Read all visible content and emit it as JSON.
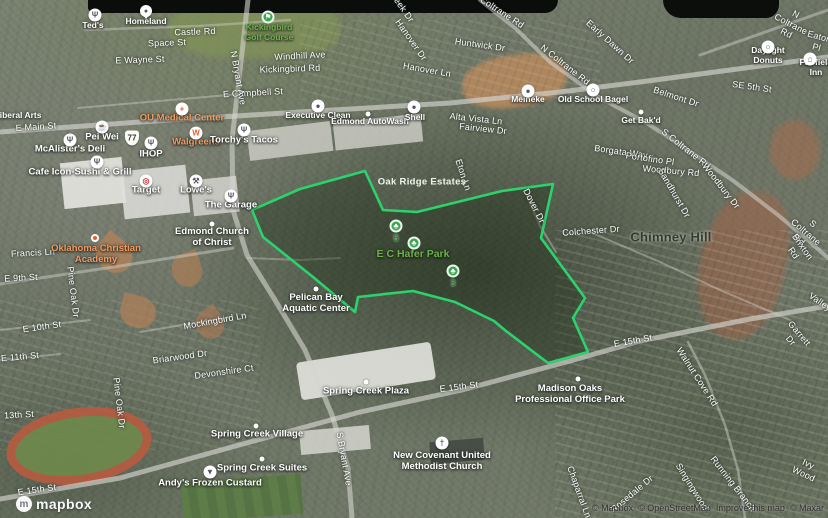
{
  "map": {
    "view": "satellite-3d",
    "route_shield": "77",
    "logo_text": "mapbox",
    "attribution": [
      "© Mapbox",
      "© OpenStreetMap",
      "Improve this map",
      "© Maxar"
    ],
    "polygon": {
      "name": "E C Hafer Park boundary highlight",
      "color": "#2bd36e",
      "points": "252,210 300,189 365,171 383,210 417,212 502,191 553,184 541,238 585,298 573,318 588,352 548,363 506,331 494,321 455,302 413,291 358,297 355,312 313,277 263,237"
    },
    "labels": [
      {
        "id": "castle-rd",
        "t": "Castle Rd",
        "x": 195,
        "y": 32,
        "r": -2,
        "c": "st"
      },
      {
        "id": "space-st",
        "t": "Space St",
        "x": 167,
        "y": 43,
        "r": -2,
        "c": "st"
      },
      {
        "id": "e-wayne-st",
        "t": "E Wayne St",
        "x": 140,
        "y": 60,
        "r": -2,
        "c": "st"
      },
      {
        "id": "e-campbell-st",
        "t": "E Campbell St",
        "x": 253,
        "y": 93,
        "r": -3,
        "c": "st"
      },
      {
        "id": "e-main-st",
        "t": "E Main St",
        "x": 36,
        "y": 127,
        "r": -4,
        "c": "st"
      },
      {
        "id": "n-bryant-ave",
        "t": "N Bryant Ave",
        "x": 238,
        "y": 78,
        "r": 80,
        "c": "st"
      },
      {
        "id": "windhill-ave",
        "t": "Windhill Ave",
        "x": 300,
        "y": 56,
        "r": -3,
        "c": "st"
      },
      {
        "id": "kickingbird-rd",
        "t": "Kickingbird Rd",
        "x": 290,
        "y": 69,
        "r": -2,
        "c": "st"
      },
      {
        "id": "creek-dr",
        "t": "Creek Dr",
        "x": 401,
        "y": 6,
        "r": 55,
        "c": "st"
      },
      {
        "id": "hanover-dr",
        "t": "Hanover Dr",
        "x": 411,
        "y": 40,
        "r": 55,
        "c": "st"
      },
      {
        "id": "hanover-ln",
        "t": "Hanover Ln",
        "x": 427,
        "y": 70,
        "r": 10,
        "c": "st"
      },
      {
        "id": "huntwick-dr",
        "t": "Huntwick Dr",
        "x": 480,
        "y": 45,
        "r": 8,
        "c": "st"
      },
      {
        "id": "n-coltrane-rd-1",
        "t": "N Coltrane Rd",
        "x": 498,
        "y": 10,
        "r": 33,
        "c": "st"
      },
      {
        "id": "n-coltrane-rd-2",
        "t": "N Coltrane Rd",
        "x": 565,
        "y": 65,
        "r": 38,
        "c": "st"
      },
      {
        "id": "n-coltrane-rd-3",
        "t": "N Coltrane Rd",
        "x": 791,
        "y": 24,
        "r": 27,
        "c": "st"
      },
      {
        "id": "early-dawn-dr",
        "t": "Early Dawn Dr",
        "x": 610,
        "y": 42,
        "r": 42,
        "c": "st"
      },
      {
        "id": "eaton-pl",
        "t": "Eaton Pl",
        "x": 818,
        "y": 42,
        "r": 15,
        "c": "st"
      },
      {
        "id": "se-5th-st",
        "t": "SE 5th St",
        "x": 752,
        "y": 87,
        "r": 8,
        "c": "st"
      },
      {
        "id": "belmont-dr",
        "t": "Belmont Dr",
        "x": 676,
        "y": 97,
        "r": 18,
        "c": "st"
      },
      {
        "id": "alta-vista-ln",
        "t": "Alta Vista Ln",
        "x": 476,
        "y": 119,
        "r": 6,
        "c": "st"
      },
      {
        "id": "fairview-dr",
        "t": "Fairview Dr",
        "x": 483,
        "y": 129,
        "r": 6,
        "c": "st"
      },
      {
        "id": "eton-ln",
        "t": "Eton Ln",
        "x": 463,
        "y": 175,
        "r": 72,
        "c": "st"
      },
      {
        "id": "dover-dr",
        "t": "Dover Dr",
        "x": 534,
        "y": 206,
        "r": 63,
        "c": "st"
      },
      {
        "id": "s-coltrane-rd-1",
        "t": "S Coltrane Rd",
        "x": 686,
        "y": 149,
        "r": 38,
        "c": "st"
      },
      {
        "id": "s-coltrane-rd-2",
        "t": "S Coltrane Rd",
        "x": 806,
        "y": 232,
        "r": 40,
        "c": "st"
      },
      {
        "id": "borgata-way",
        "t": "Borgata Way",
        "x": 621,
        "y": 152,
        "r": 8,
        "c": "st"
      },
      {
        "id": "portofino-pl",
        "t": "Portofino Pl",
        "x": 650,
        "y": 159,
        "r": 8,
        "c": "st"
      },
      {
        "id": "woodbury-rd",
        "t": "Woodbury Rd",
        "x": 671,
        "y": 171,
        "r": 5,
        "c": "st"
      },
      {
        "id": "woodbury-dr",
        "t": "Woodbury Dr",
        "x": 721,
        "y": 186,
        "r": 52,
        "c": "st"
      },
      {
        "id": "sandhurst-dr",
        "t": "Sandhurst Dr",
        "x": 674,
        "y": 193,
        "r": 60,
        "c": "st"
      },
      {
        "id": "colchester-dr",
        "t": "Colchester Dr",
        "x": 591,
        "y": 231,
        "r": -4,
        "c": "st"
      },
      {
        "id": "brixton-rd",
        "t": "Brixton Rd",
        "x": 798,
        "y": 250,
        "r": 55,
        "c": "st"
      },
      {
        "id": "valley-rd",
        "t": "Valley",
        "x": 820,
        "y": 302,
        "r": 35,
        "c": "st"
      },
      {
        "id": "garrett-dr",
        "t": "Garrett Dr",
        "x": 795,
        "y": 337,
        "r": 50,
        "c": "st"
      },
      {
        "id": "francis-ln",
        "t": "Francis Ln",
        "x": 33,
        "y": 253,
        "r": -3,
        "c": "st"
      },
      {
        "id": "e-9th-st",
        "t": "E 9th St",
        "x": 21,
        "y": 278,
        "r": -3,
        "c": "st"
      },
      {
        "id": "pine-oak-dr-1",
        "t": "Pine Oak Dr",
        "x": 73,
        "y": 292,
        "r": 83,
        "c": "st"
      },
      {
        "id": "pine-oak-dr-2",
        "t": "Pine Oak Dr",
        "x": 119,
        "y": 403,
        "r": 83,
        "c": "st"
      },
      {
        "id": "mockingbird-ln",
        "t": "Mockingbird Ln",
        "x": 215,
        "y": 321,
        "r": -10,
        "c": "st"
      },
      {
        "id": "e-10th-st",
        "t": "E 10th St",
        "x": 42,
        "y": 327,
        "r": -8,
        "c": "st"
      },
      {
        "id": "e-11th-st",
        "t": "E 11th St",
        "x": 20,
        "y": 357,
        "r": -5,
        "c": "st"
      },
      {
        "id": "briarwood-dr",
        "t": "Briarwood Dr",
        "x": 180,
        "y": 357,
        "r": -8,
        "c": "st"
      },
      {
        "id": "devonshire-ct",
        "t": "Devonshire Ct",
        "x": 224,
        "y": 372,
        "r": -8,
        "c": "st"
      },
      {
        "id": "13th-st",
        "t": "13th St",
        "x": 19,
        "y": 415,
        "r": -3,
        "c": "st"
      },
      {
        "id": "e-15th-st-1",
        "t": "E 15th St",
        "x": 459,
        "y": 387,
        "r": -7,
        "c": "st"
      },
      {
        "id": "e-15th-st-2",
        "t": "E 15th St",
        "x": 633,
        "y": 341,
        "r": -10,
        "c": "st"
      },
      {
        "id": "e-15th-st-3",
        "t": "E 15th St",
        "x": 37,
        "y": 490,
        "r": -8,
        "c": "st"
      },
      {
        "id": "walnut-cove-rd",
        "t": "Walnut Cove Rd",
        "x": 697,
        "y": 377,
        "r": 57,
        "c": "st"
      },
      {
        "id": "chaparral-ln",
        "t": "Chaparral Ln",
        "x": 579,
        "y": 492,
        "r": 70,
        "c": "st"
      },
      {
        "id": "rosedale-dr",
        "t": "Rosedale Dr",
        "x": 632,
        "y": 494,
        "r": -40,
        "c": "st"
      },
      {
        "id": "singingwood",
        "t": "Singingwood",
        "x": 692,
        "y": 487,
        "r": 58,
        "c": "st"
      },
      {
        "id": "running-branch",
        "t": "Running Branch",
        "x": 733,
        "y": 484,
        "r": 52,
        "c": "st"
      },
      {
        "id": "ivy-wood",
        "t": "Ivy Wood",
        "x": 806,
        "y": 469,
        "r": 25,
        "c": "st"
      },
      {
        "id": "s-bryant-ave",
        "t": "S Bryant Ave",
        "x": 344,
        "y": 459,
        "r": 80,
        "c": "st"
      },
      {
        "id": "teds",
        "t": "Ted's",
        "x": 93,
        "y": 25,
        "r": 0,
        "c": "poi sm"
      },
      {
        "id": "homeland",
        "t": "Homeland",
        "x": 146,
        "y": 21,
        "r": 0,
        "c": "poi sm"
      },
      {
        "id": "kickingbird-golf-course",
        "t": "Kickingbird\nGolf Course",
        "x": 269,
        "y": 32,
        "r": 0,
        "c": "poi sm park"
      },
      {
        "id": "ou-medical-center",
        "t": "OU Medical Center",
        "x": 182,
        "y": 118,
        "r": 0,
        "c": "poi brand"
      },
      {
        "id": "pei-wei",
        "t": "Pei Wei",
        "x": 102,
        "y": 137,
        "r": 0,
        "c": "poi"
      },
      {
        "id": "walgreens",
        "t": "Walgreens",
        "x": 196,
        "y": 142,
        "r": 0,
        "c": "poi brand"
      },
      {
        "id": "torchys-tacos",
        "t": "Torchy's Tacos",
        "x": 244,
        "y": 140,
        "r": 0,
        "c": "poi"
      },
      {
        "id": "mcalisters-deli",
        "t": "McAlister's Deli",
        "x": 70,
        "y": 149,
        "r": 0,
        "c": "poi"
      },
      {
        "id": "ihop",
        "t": "IHOP",
        "x": 151,
        "y": 154,
        "r": 0,
        "c": "poi"
      },
      {
        "id": "cafe-icon-sushi-grill",
        "t": "Cafe Icon-Sushi & Grill",
        "x": 80,
        "y": 172,
        "r": 0,
        "c": "poi"
      },
      {
        "id": "target",
        "t": "Target",
        "x": 146,
        "y": 190,
        "r": 0,
        "c": "poi"
      },
      {
        "id": "lowes",
        "t": "Lowe's",
        "x": 196,
        "y": 190,
        "r": 0,
        "c": "poi"
      },
      {
        "id": "the-garage",
        "t": "The Garage",
        "x": 231,
        "y": 205,
        "r": 0,
        "c": "poi"
      },
      {
        "id": "executive-clean",
        "t": "Executive Clean",
        "x": 318,
        "y": 115,
        "r": 0,
        "c": "poi sm"
      },
      {
        "id": "edmond-autowash",
        "t": "Edmond AutoWash",
        "x": 370,
        "y": 121,
        "r": 0,
        "c": "poi sm"
      },
      {
        "id": "shell",
        "t": "Shell",
        "x": 415,
        "y": 117,
        "r": 0,
        "c": "poi sm"
      },
      {
        "id": "meineke",
        "t": "Meineke",
        "x": 528,
        "y": 99,
        "r": 0,
        "c": "poi sm"
      },
      {
        "id": "old-school-bagel",
        "t": "Old School Bagel",
        "x": 593,
        "y": 99,
        "r": 0,
        "c": "poi sm"
      },
      {
        "id": "daylight-donuts",
        "t": "Daylight Donuts",
        "x": 768,
        "y": 55,
        "r": 0,
        "c": "poi sm"
      },
      {
        "id": "fairfield-inn",
        "t": "Fairfield Inn",
        "x": 816,
        "y": 67,
        "r": 0,
        "c": "poi sm"
      },
      {
        "id": "get-bakd",
        "t": "Get Bak'd",
        "x": 641,
        "y": 120,
        "r": 0,
        "c": "poi sm"
      },
      {
        "id": "oak-ridge-estates",
        "t": "Oak Ridge Estates",
        "x": 422,
        "y": 182,
        "r": 0,
        "c": "hood"
      },
      {
        "id": "chimney-hill",
        "t": "Chimney Hill",
        "x": 671,
        "y": 237,
        "r": 0,
        "c": "hd"
      },
      {
        "id": "liberal-arts",
        "t": "Liberal Arts",
        "x": 18,
        "y": 115,
        "r": 0,
        "c": "poi sm"
      },
      {
        "id": "e-c-hafer-park",
        "t": "E C Hafer Park",
        "x": 413,
        "y": 254,
        "r": 0,
        "c": "park pkbig"
      },
      {
        "id": "pelican-bay-aquatic-center",
        "t": "Pelican Bay\nAquatic Center",
        "x": 316,
        "y": 303,
        "r": 0,
        "c": "poi"
      },
      {
        "id": "oklahoma-christian-academy",
        "t": "Oklahoma Christian\nAcademy",
        "x": 96,
        "y": 254,
        "r": 0,
        "c": "poi brand"
      },
      {
        "id": "edmond-church-of-christ",
        "t": "Edmond Church\nof Christ",
        "x": 212,
        "y": 237,
        "r": 0,
        "c": "poi"
      },
      {
        "id": "spring-creek-plaza",
        "t": "Spring Creek Plaza",
        "x": 366,
        "y": 391,
        "r": 0,
        "c": "poi"
      },
      {
        "id": "madison-oaks-office-park",
        "t": "Madison Oaks\nProfessional Office Park",
        "x": 570,
        "y": 394,
        "r": 0,
        "c": "poi"
      },
      {
        "id": "spring-creek-village",
        "t": "Spring Creek Village",
        "x": 257,
        "y": 434,
        "r": 0,
        "c": "po0i poi"
      },
      {
        "id": "spring-creek-suites",
        "t": "Spring Creek Suites",
        "x": 262,
        "y": 468,
        "r": 0,
        "c": "poi"
      },
      {
        "id": "andys-frozen-custard",
        "t": "Andy's Frozen Custard",
        "x": 210,
        "y": 483,
        "r": 0,
        "c": "poi"
      },
      {
        "id": "new-covenant-umc",
        "t": "New Covenant United\nMethodist Church",
        "x": 442,
        "y": 461,
        "r": 0,
        "c": "poi"
      }
    ],
    "icons": [
      {
        "id": "teds-restaurant-icon",
        "g": "Ψ",
        "x": 95,
        "y": 15,
        "k": "w"
      },
      {
        "id": "homeland-pin-icon",
        "g": "●",
        "x": 146,
        "y": 11,
        "k": "p"
      },
      {
        "id": "kickingbird-golf-icon",
        "g": "⚑",
        "x": 268,
        "y": 17,
        "k": "g"
      },
      {
        "id": "ou-medical-cross-icon",
        "g": "+",
        "x": 182,
        "y": 109,
        "k": "w",
        "gc": "#e25c3c"
      },
      {
        "id": "pei-wei-cup-icon",
        "g": "☕",
        "x": 102,
        "y": 127,
        "k": "w"
      },
      {
        "id": "walgreens-icon",
        "g": "W",
        "x": 196,
        "y": 133,
        "k": "w",
        "gc": "#e8602c"
      },
      {
        "id": "torchys-restaurant-icon",
        "g": "Ψ",
        "x": 244,
        "y": 130,
        "k": "w"
      },
      {
        "id": "mcalisters-restaurant-icon",
        "g": "Ψ",
        "x": 70,
        "y": 140,
        "k": "w"
      },
      {
        "id": "ihop-restaurant-icon",
        "g": "Ψ",
        "x": 151,
        "y": 143,
        "k": "w"
      },
      {
        "id": "cafe-icon-restaurant-icon",
        "g": "Ψ",
        "x": 97,
        "y": 162,
        "k": "w"
      },
      {
        "id": "target-bullseye-icon",
        "g": "◎",
        "x": 146,
        "y": 181,
        "k": "w",
        "gc": "#cc3333"
      },
      {
        "id": "lowes-wrench-icon",
        "g": "⚒",
        "x": 196,
        "y": 181,
        "k": "w"
      },
      {
        "id": "the-garage-restaurant-icon",
        "g": "Ψ",
        "x": 231,
        "y": 196,
        "k": "w"
      },
      {
        "id": "executive-clean-car-icon",
        "g": "●",
        "x": 318,
        "y": 106,
        "k": "w"
      },
      {
        "id": "edmond-autowash-dot-icon",
        "g": "",
        "x": 368,
        "y": 114,
        "k": "d"
      },
      {
        "id": "shell-fuel-icon",
        "g": "●",
        "x": 414,
        "y": 107,
        "k": "w"
      },
      {
        "id": "meineke-car-icon",
        "g": "●",
        "x": 528,
        "y": 91,
        "k": "w"
      },
      {
        "id": "old-school-bagel-icon",
        "g": "○",
        "x": 593,
        "y": 90,
        "k": "w"
      },
      {
        "id": "daylight-donuts-icon",
        "g": "○",
        "x": 768,
        "y": 47,
        "k": "w"
      },
      {
        "id": "fairfield-inn-lodging-icon",
        "g": "⌂",
        "x": 810,
        "y": 59,
        "k": "w"
      },
      {
        "id": "get-bakd-dot-icon",
        "g": "",
        "x": 641,
        "y": 112,
        "k": "d"
      },
      {
        "id": "hafer-park-marker-5",
        "g": "♣",
        "x": 396,
        "y": 226,
        "k": "g",
        "n": "5"
      },
      {
        "id": "hafer-park-tree-icon",
        "g": "♣",
        "x": 414,
        "y": 243,
        "k": "g"
      },
      {
        "id": "hafer-park-marker-3",
        "g": "♣",
        "x": 453,
        "y": 271,
        "k": "g",
        "n": "3"
      },
      {
        "id": "pelican-bay-dot-icon",
        "g": "",
        "x": 316,
        "y": 289,
        "k": "d"
      },
      {
        "id": "ok-christian-academy-dot-icon",
        "g": "",
        "x": 95,
        "y": 238,
        "k": "o"
      },
      {
        "id": "edmond-church-dot-icon",
        "g": "",
        "x": 212,
        "y": 224,
        "k": "d"
      },
      {
        "id": "spring-creek-plaza-dot-icon",
        "g": "",
        "x": 366,
        "y": 382,
        "k": "d"
      },
      {
        "id": "madison-oaks-dot-icon",
        "g": "",
        "x": 578,
        "y": 379,
        "k": "d"
      },
      {
        "id": "spring-creek-village-dot-icon",
        "g": "",
        "x": 256,
        "y": 426,
        "k": "d"
      },
      {
        "id": "spring-creek-suites-dot-icon",
        "g": "",
        "x": 262,
        "y": 459,
        "k": "d"
      },
      {
        "id": "andys-custard-icon",
        "g": "▼",
        "x": 210,
        "y": 472,
        "k": "w"
      },
      {
        "id": "new-covenant-church-icon",
        "g": "†",
        "x": 442,
        "y": 443,
        "k": "w"
      }
    ]
  }
}
